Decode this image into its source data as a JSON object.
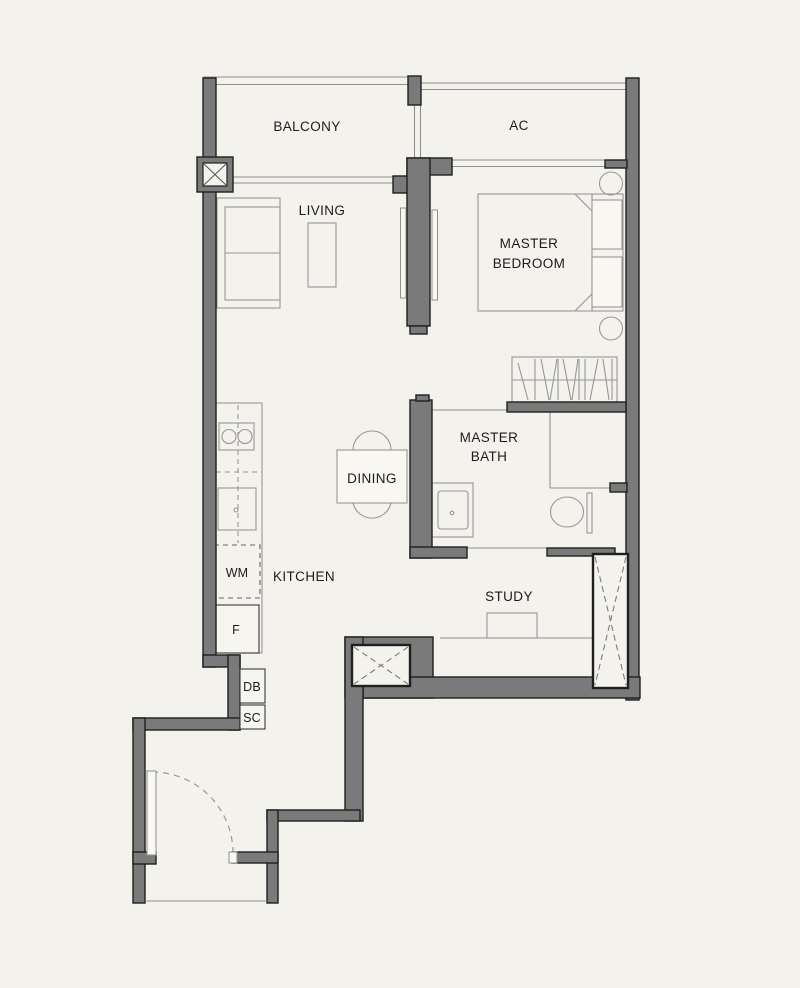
{
  "colors": {
    "background": "#f4f2ed",
    "wall_fill": "#7a7a7a",
    "wall_outline": "#1f1f1f",
    "furniture_line": "#979797",
    "window_line": "#8f8f8f",
    "text": "#1b1b1b"
  },
  "rooms": {
    "balcony": {
      "label": "BALCONY"
    },
    "ac": {
      "label": "AC"
    },
    "living": {
      "label": "LIVING"
    },
    "master_bedroom": {
      "line1": "MASTER",
      "line2": "BEDROOM"
    },
    "dining": {
      "label": "DINING"
    },
    "master_bath": {
      "line1": "MASTER",
      "line2": "BATH"
    },
    "kitchen": {
      "label": "KITCHEN"
    },
    "study": {
      "label": "STUDY"
    }
  },
  "fixtures": {
    "washer": "WM",
    "fridge": "F",
    "db": "DB",
    "sc": "SC"
  }
}
